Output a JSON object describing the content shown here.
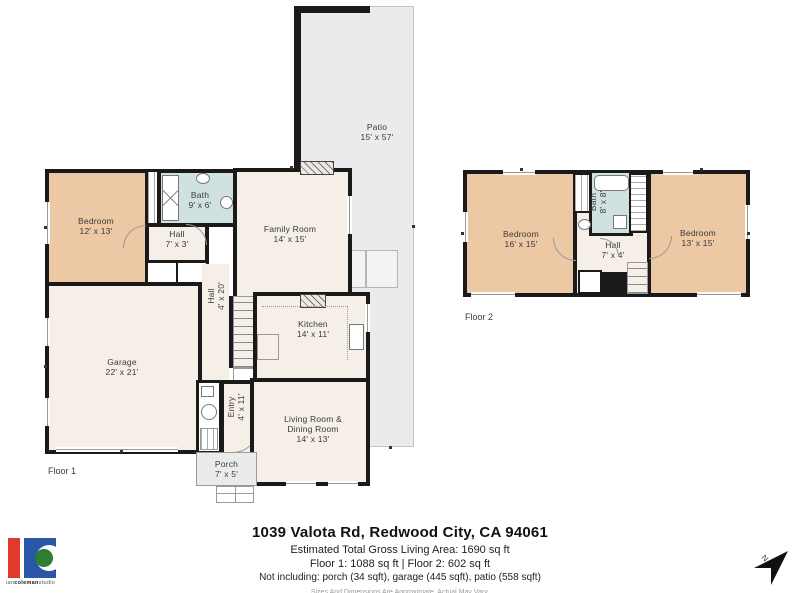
{
  "colors": {
    "bedroom_fill": "#ecc8a4",
    "bath_fill": "#cfe2e0",
    "interior_fill": "#f5efe7",
    "outdoor_fill": "#ebebeb",
    "wall": "#1a1a1a",
    "logo_red": "#e03a2f",
    "logo_blue": "#2b57a8",
    "logo_green": "#2e7d32"
  },
  "floor1": {
    "label": "Floor 1",
    "rooms": [
      {
        "name": "Bedroom",
        "dims": "12' x 13'"
      },
      {
        "name": "Bath",
        "dims": "9' x 6'"
      },
      {
        "name": "Hall",
        "dims": "7' x 3'"
      },
      {
        "name": "Family Room",
        "dims": "14' x 15'"
      },
      {
        "name": "Hall",
        "dims": "4' x 20'"
      },
      {
        "name": "Garage",
        "dims": "22' x 21'"
      },
      {
        "name": "Kitchen",
        "dims": "14' x 11'"
      },
      {
        "name": "Entry",
        "dims": "4' x 11'"
      },
      {
        "name": "Living Room &",
        "name2": "Dining Room",
        "dims": "14' x 13'"
      },
      {
        "name": "Porch",
        "dims": "7' x 5'"
      },
      {
        "name": "Patio",
        "dims": "15' x 57'"
      }
    ]
  },
  "floor2": {
    "label": "Floor 2",
    "rooms": [
      {
        "name": "Bedroom",
        "dims": "16' x 15'"
      },
      {
        "name": "Bath",
        "dims": "8' x 8'"
      },
      {
        "name": "Hall",
        "dims": "7' x 4'"
      },
      {
        "name": "Bedroom",
        "dims": "13' x 15'"
      }
    ]
  },
  "footer": {
    "address": "1039 Valota Rd, Redwood City, CA 94061",
    "living_area": "Estimated Total Gross Living Area: 1690 sq ft",
    "floor_areas": "Floor 1: 1088 sq ft | Floor 2: 602 sq ft",
    "exclusions": "Not including: porch (34 sqft), garage (445 sqft), patio (558 sqft)",
    "disclaimer": "Sizes And Dimensions Are Approximate, Actual May Vary."
  },
  "logo": {
    "part1": "ian",
    "part2": "coleman",
    "part3": "studio"
  },
  "compass": {
    "label": "N"
  }
}
